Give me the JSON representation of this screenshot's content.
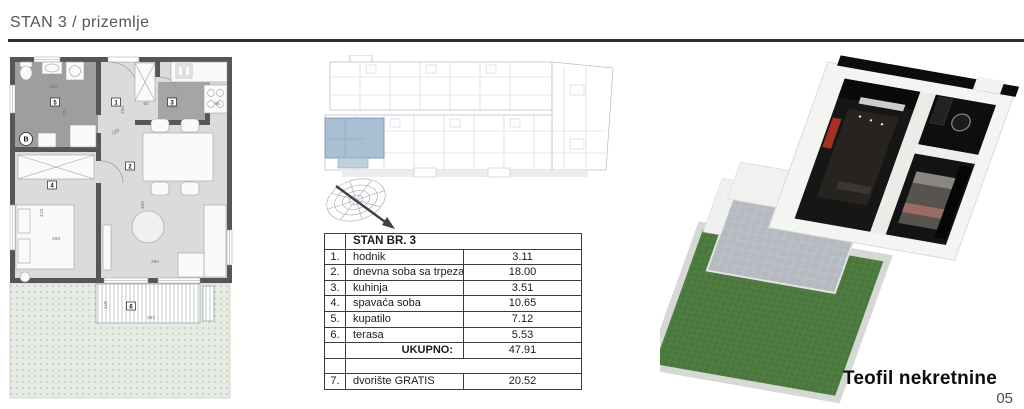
{
  "header": {
    "title": "STAN 3 / prizemlje"
  },
  "floorplan": {
    "room_labels": [
      "1",
      "2",
      "3",
      "4",
      "5",
      "6"
    ],
    "entry_label": "B",
    "dims": [
      "260",
      "275",
      "204",
      "120",
      "60",
      "105",
      "66",
      "410",
      "260",
      "300",
      "360",
      "392",
      "118"
    ]
  },
  "table": {
    "header": "STAN BR. 3",
    "rows": [
      {
        "num": "1.",
        "name": "hodnik",
        "value": "3.11"
      },
      {
        "num": "2.",
        "name": "dnevna soba sa trpezarijom",
        "value": "18.00"
      },
      {
        "num": "3.",
        "name": "kuhinja",
        "value": "3.51"
      },
      {
        "num": "4.",
        "name": "spavaća soba",
        "value": "10.65"
      },
      {
        "num": "5.",
        "name": "kupatilo",
        "value": "7.12"
      },
      {
        "num": "6.",
        "name": "terasa",
        "value": "5.53"
      }
    ],
    "total_label": "UKUPNO:",
    "total_value": "47.91",
    "bonus": {
      "num": "7.",
      "name": "dvorište GRATIS",
      "value": "20.52"
    }
  },
  "footer": {
    "brand": "Teofil nekretnine",
    "page": "05"
  },
  "colors": {
    "rule": "#27303b",
    "wall": "#55565a",
    "bath_floor": "#9c9ea0",
    "living_floor": "#dbdbd9",
    "yard": "#e6ebe4",
    "highlight_unit_blue": "#a9c0d4",
    "grass": "#4d7a3f",
    "tile": "#b5bac1",
    "accent_red": "#a63122"
  }
}
